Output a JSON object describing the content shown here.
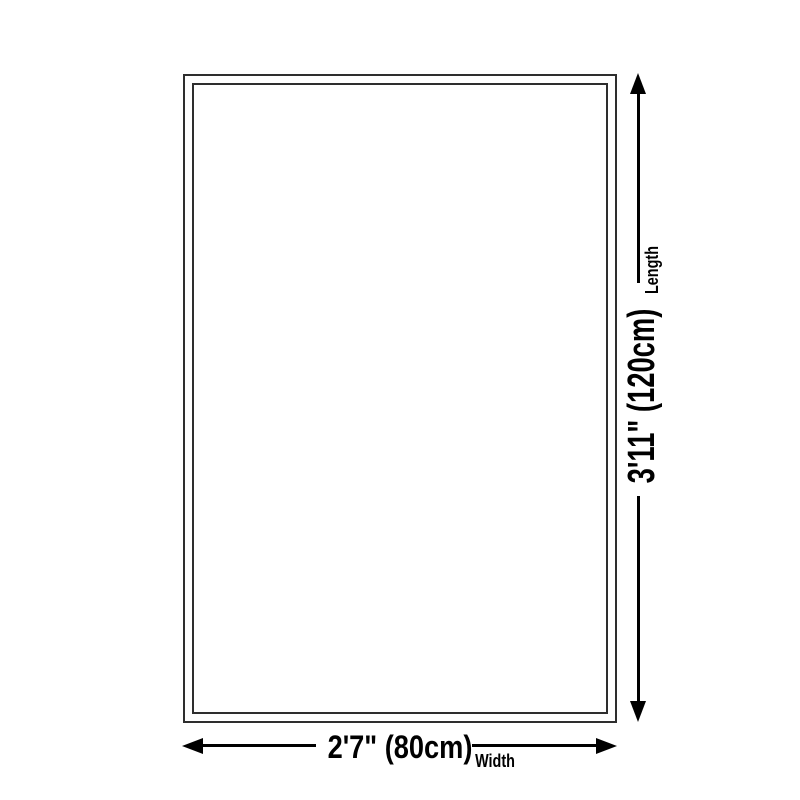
{
  "diagram": {
    "type": "product-size-diagram",
    "length": {
      "value": "3'11\" (120cm)",
      "label": "Length"
    },
    "width": {
      "value": "2'7\" (80cm)",
      "label": "Width"
    },
    "colors": {
      "background": "#ffffff",
      "outline": "#2e2e2e",
      "marks": "#000000"
    }
  }
}
